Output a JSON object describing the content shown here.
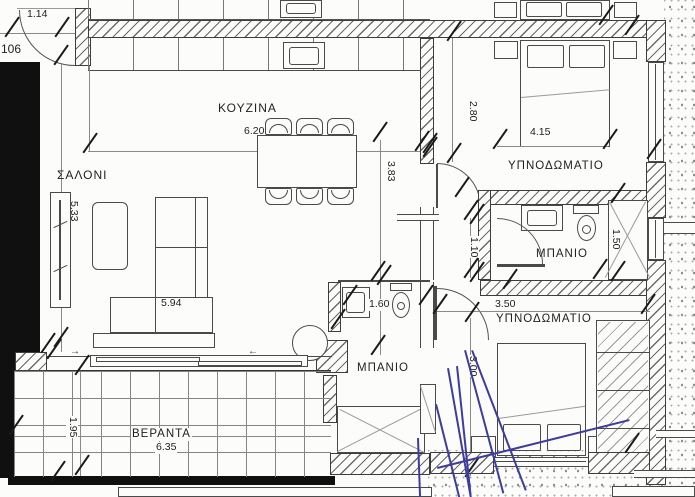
{
  "plan": {
    "unit_label": "106",
    "rooms": {
      "living": "ΣΑΛΟΝΙ",
      "kitchen": "ΚΟΥΖΙΝΑ",
      "bedroom1": "ΥΠΝΟΔΩΜΑΤΙΟ",
      "bath1": "ΜΠΑΝΙΟ",
      "bath2": "ΜΠΑΝΙΟ",
      "bedroom2": "ΥΠΝΟΔΩΜΑΤΙΟ",
      "veranda": "ΒΕΡΑΝΤΑ"
    },
    "dims": {
      "entry": "1.14",
      "living_h": "5.33",
      "kitchen_w": "6.20",
      "hall_h": "3.83",
      "sofa": "5.94",
      "bed1_w": "4.15",
      "bed1_h": "2.80",
      "shower1_h": "1.50",
      "corridor": "1.10",
      "bath2_w": "1.60",
      "bed2_w": "3.50",
      "bed2_h": "3.00",
      "veranda_w": "6.35",
      "veranda_h": "1.95"
    },
    "icons": {
      "slide_right": "→",
      "slide_left": "←"
    },
    "colors": {
      "ink": "#3a3a3a",
      "wall_fill": "#101010",
      "paper": "#fcfcfa",
      "pen_annotation": "#3c3d9e"
    }
  }
}
